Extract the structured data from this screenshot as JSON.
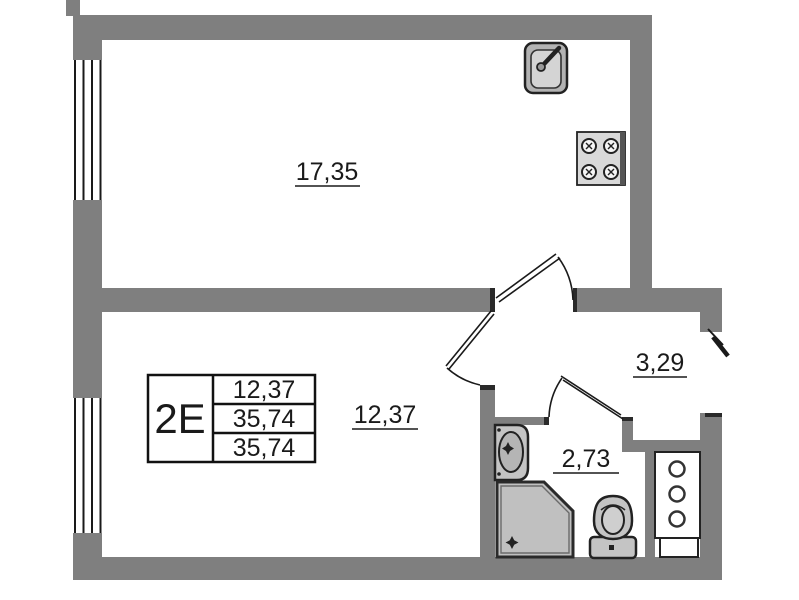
{
  "plan": {
    "unit": {
      "type_label": "2E",
      "stats": [
        "12,37",
        "35,74",
        "35,74"
      ]
    },
    "rooms": [
      {
        "id": "living-kitchen",
        "area": "17,35"
      },
      {
        "id": "room",
        "area": "12,37"
      },
      {
        "id": "hallway",
        "area": "3,29"
      },
      {
        "id": "bathroom",
        "area": "2,73"
      }
    ],
    "fixtures": [
      "kitchen-sink",
      "stove",
      "washbasin",
      "shower",
      "toilet",
      "ventilation-shaft"
    ],
    "colors": {
      "wall": "#7f7f7f",
      "outline": "#222222",
      "fixture_fill": "#c4c4c4",
      "background": "#ffffff",
      "text": "#1a1a1a"
    }
  }
}
